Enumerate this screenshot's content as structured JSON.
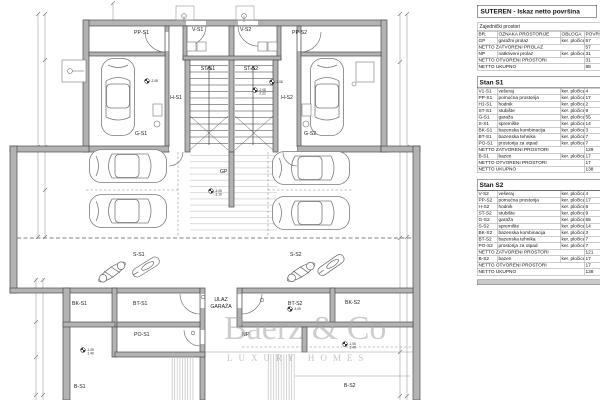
{
  "table": {
    "title": "SUTEREN - Iskaz netto površina",
    "columns": [
      "BR.",
      "OZNAKA PROSTORIJE",
      "OBLOGA",
      "POVRŠINA"
    ],
    "sections": [
      {
        "id": "common",
        "heading": "Zajednički prostori",
        "heading_style": "plain",
        "show_columns": true,
        "rows": [
          [
            "GP",
            "garažni prolaz",
            "ker. pločice",
            "57"
          ],
          [
            "",
            "NETTO ZATVORENI PROLAZ",
            "",
            "57"
          ],
          [
            "NP",
            "natkriveni prolaz",
            "ker. pločice",
            "31"
          ],
          [
            "",
            "NETTO OTVORENI PROSTORI",
            "",
            "31"
          ],
          [
            "",
            "NETTO UKUPNO",
            "",
            "88"
          ]
        ]
      },
      {
        "id": "stan-s1",
        "heading": "Stan S1",
        "heading_style": "bold",
        "show_columns": false,
        "rows": [
          [
            "V1-S1",
            "vešeraj",
            "ker. pločice",
            "4"
          ],
          [
            "PP-S1",
            "pomoćna prostorija",
            "ker. pločice",
            "17"
          ],
          [
            "H1-S1",
            "hodnik",
            "ker. pločice",
            "2"
          ],
          [
            "ST-S1",
            "stubište",
            "ker. pločice",
            "9"
          ],
          [
            "G-S1",
            "garaža",
            "ker. pločice",
            "55"
          ],
          [
            "S-S1",
            "spremište",
            "ker. pločice",
            "14"
          ],
          [
            "BK-S1",
            "bazenska kombinacija",
            "ker. pločice",
            "3"
          ],
          [
            "BT-S1",
            "bazenska tehnika",
            "ker. pločice",
            "7"
          ],
          [
            "PO-S1",
            "prostorija za otpad",
            "ker. pločice",
            "7"
          ],
          [
            "",
            "NETTO ZATVORENI PROSTORI",
            "",
            "129"
          ],
          [
            "B-S1",
            "bazen",
            "ker. pločice",
            "17"
          ],
          [
            "",
            "NETTO OTVORENI PROSTORI",
            "",
            "17"
          ],
          [
            "",
            "NETTO UKUPNO",
            "",
            "138"
          ]
        ]
      },
      {
        "id": "stan-s2",
        "heading": "Stan S2",
        "heading_style": "bold",
        "show_columns": false,
        "rows": [
          [
            "V-S2",
            "vešeraj",
            "ker. pločice",
            "4"
          ],
          [
            "PP-S2",
            "pomoćna prostorija",
            "ker. pločice",
            "17"
          ],
          [
            "H-S2",
            "hodnik",
            "ker. pločice",
            "6"
          ],
          [
            "ST-S2",
            "stubište",
            "ker. pločice",
            "9"
          ],
          [
            "G-S2",
            "garaža",
            "ker. pločice",
            "55"
          ],
          [
            "S-S2",
            "spremište",
            "ker. pločice",
            "14"
          ],
          [
            "BK-S2",
            "bazenska kombinacija",
            "ker. pločice",
            "3"
          ],
          [
            "BT-S2",
            "bazenska tehnika",
            "ker. pločice",
            "7"
          ],
          [
            "PO-S2",
            "prostorija za otpad",
            "ker. pločice",
            "7"
          ],
          [
            "",
            "NETTO ZATVORENI PROSTORI",
            "",
            "121"
          ],
          [
            "B-S2",
            "bazen",
            "ker. pločice",
            "17"
          ],
          [
            "",
            "NETTO OTVORENI PROSTORI",
            "",
            "17"
          ],
          [
            "",
            "NETTO UKUPNO",
            "",
            "138"
          ]
        ]
      }
    ]
  },
  "plan": {
    "room_labels": [
      {
        "t": "PP-S1",
        "x": 134,
        "y": 34
      },
      {
        "t": "V-S1",
        "x": 192,
        "y": 31
      },
      {
        "t": "V-S2",
        "x": 240,
        "y": 31
      },
      {
        "t": "PP-S2",
        "x": 292,
        "y": 34
      },
      {
        "t": "ST-S1",
        "x": 208,
        "y": 70,
        "a": "m"
      },
      {
        "t": "ST-S2",
        "x": 251,
        "y": 70,
        "a": "m"
      },
      {
        "t": "H-S1",
        "x": 176,
        "y": 99,
        "a": "m"
      },
      {
        "t": "H-S2",
        "x": 287,
        "y": 99,
        "a": "m"
      },
      {
        "t": "G-S1",
        "x": 135,
        "y": 135
      },
      {
        "t": "G-S2",
        "x": 304,
        "y": 135
      },
      {
        "t": "GP",
        "x": 220,
        "y": 173
      },
      {
        "t": "S-S1",
        "x": 133,
        "y": 256
      },
      {
        "t": "S-S2",
        "x": 290,
        "y": 256
      },
      {
        "t": "BK-S1",
        "x": 72,
        "y": 305
      },
      {
        "t": "BT-S1",
        "x": 133,
        "y": 305
      },
      {
        "t": "ULAZ",
        "x": 221,
        "y": 301,
        "a": "m"
      },
      {
        "t": "GARAŽA",
        "x": 221,
        "y": 308,
        "a": "m"
      },
      {
        "t": "BT-S2",
        "x": 288,
        "y": 305
      },
      {
        "t": "BK-S2",
        "x": 345,
        "y": 304
      },
      {
        "t": "PO-S1",
        "x": 134,
        "y": 336
      },
      {
        "t": "NP",
        "x": 242,
        "y": 336
      },
      {
        "t": "B-S1",
        "x": 74,
        "y": 388
      },
      {
        "t": "B-S2",
        "x": 344,
        "y": 387
      }
    ],
    "level_markers": [
      {
        "x": 147,
        "y": 81,
        "lines": [
          "-2.08"
        ]
      },
      {
        "x": 272,
        "y": 82,
        "lines": [
          "-2.08"
        ]
      },
      {
        "x": 255,
        "y": 90,
        "lines": [
          "-2.08",
          "-2.22"
        ]
      },
      {
        "x": 211,
        "y": 191,
        "lines": [
          "-3.05",
          "-3.19"
        ]
      },
      {
        "x": 290,
        "y": 309,
        "lines": [
          "-3.05"
        ]
      },
      {
        "x": 83,
        "y": 350,
        "lines": [
          "-1.05",
          "-1.40"
        ]
      },
      {
        "x": 345,
        "y": 344,
        "lines": [
          "-1.05",
          "-1.40"
        ]
      }
    ],
    "watermark": {
      "line1": "Baerz & Co",
      "line2": "LUXURY HOMES"
    }
  }
}
